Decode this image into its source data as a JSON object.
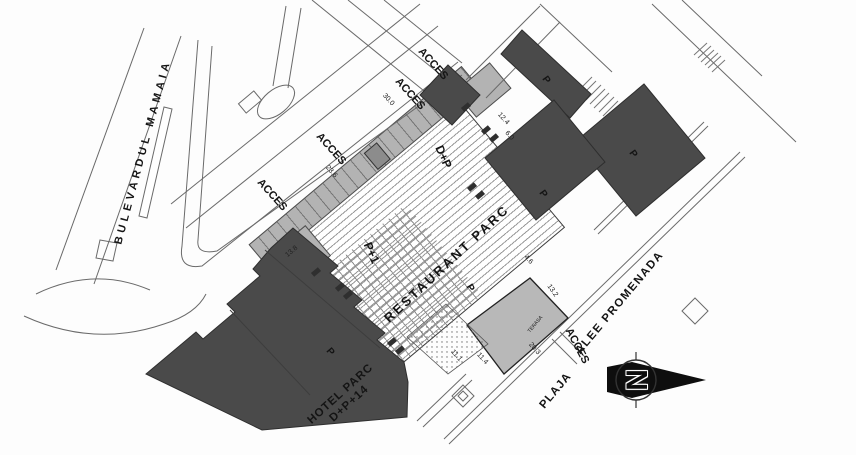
{
  "plan": {
    "streets": {
      "boulevard": "BULEVARDUL MAMAIA",
      "promenade": "ALEE PROMENADA",
      "beach": "PLAJA"
    },
    "restaurant": {
      "name": "RESTAURANT PARC",
      "height_regime": "D+P",
      "upper_regime": "P+1",
      "terrace": "TERASA"
    },
    "hotel": {
      "name": "HOTEL PARC",
      "height_regime": "D+P+14"
    },
    "access_labels": [
      "ACCES",
      "ACCES",
      "ACCES",
      "ACCES",
      "ACCES"
    ],
    "parking_labels": [
      "P",
      "P",
      "P",
      "P",
      "P"
    ],
    "dimensions": [
      "30.0",
      "23.6",
      "12.4",
      "6.0",
      "4.6",
      "13.2",
      "20.3",
      "11.4",
      "11.1",
      "13.8"
    ],
    "compass": {
      "north": "N"
    },
    "colors": {
      "building_dark": "#4a4a4a",
      "surface_gray": "#b3b3b3",
      "terrace_gray": "#b8b8b8",
      "line": "#666666"
    }
  }
}
